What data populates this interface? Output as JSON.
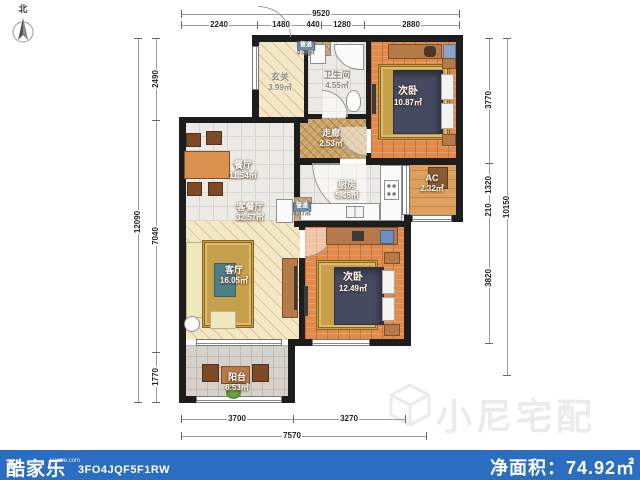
{
  "compass": {
    "label": "北"
  },
  "rooms": [
    {
      "id": "entry",
      "label": "玄关",
      "area": "3.99㎡"
    },
    {
      "id": "bathroom",
      "label": "卫生间",
      "area": "4.55㎡"
    },
    {
      "id": "bedroom-top",
      "label": "次卧",
      "area": "10.87㎡"
    },
    {
      "id": "corridor",
      "label": "走廊",
      "area": "2.53㎡"
    },
    {
      "id": "kitchen",
      "label": "厨房",
      "area": "5.45㎡"
    },
    {
      "id": "ac",
      "label": "AC",
      "area": "2.32㎡"
    },
    {
      "id": "dining",
      "label": "餐厅",
      "area": "11.54㎡"
    },
    {
      "id": "living-dining",
      "label": "客餐厅",
      "area": "32.57㎡"
    },
    {
      "id": "living",
      "label": "客厅",
      "area": "16.05㎡"
    },
    {
      "id": "bedroom-bottom",
      "label": "次卧",
      "area": "12.49㎡"
    },
    {
      "id": "balcony",
      "label": "阳台",
      "area": "6.53㎡"
    },
    {
      "id": "duct-top",
      "label": "管道",
      "area": "0.07㎡"
    },
    {
      "id": "duct-mid",
      "label": "管道",
      "area": "0.07㎡"
    }
  ],
  "dimensions": {
    "top": {
      "total": "9520",
      "segments": [
        "2240",
        "1480",
        "440",
        "1280",
        "2880"
      ]
    },
    "left": {
      "total": "12090",
      "segments": [
        "2490",
        "7040",
        "1770"
      ]
    },
    "right": {
      "total": "10150",
      "segments": [
        "3770",
        "1320",
        "210",
        "3820"
      ]
    },
    "bottom": {
      "total": "7570",
      "segments": [
        "3700",
        "3270"
      ]
    }
  },
  "watermark": {
    "text": "小尼宅配"
  },
  "footer": {
    "brand": "酷家乐",
    "brand_domain": "kujiale.com",
    "plan_code": "3FO4JQF5F1RW",
    "net_area_label": "净面积：",
    "net_area_value": "74.92㎡"
  },
  "colors": {
    "footer_bar": "#2b6dc0",
    "wall": "#1d1d1d",
    "wood_floor": "#e08a4c",
    "beige_floor": "#f3e7c8",
    "tile_floor": "#eceae6",
    "bed": "#454a60",
    "rug": "#c7a04b",
    "duct_tag": "#7188ab"
  }
}
